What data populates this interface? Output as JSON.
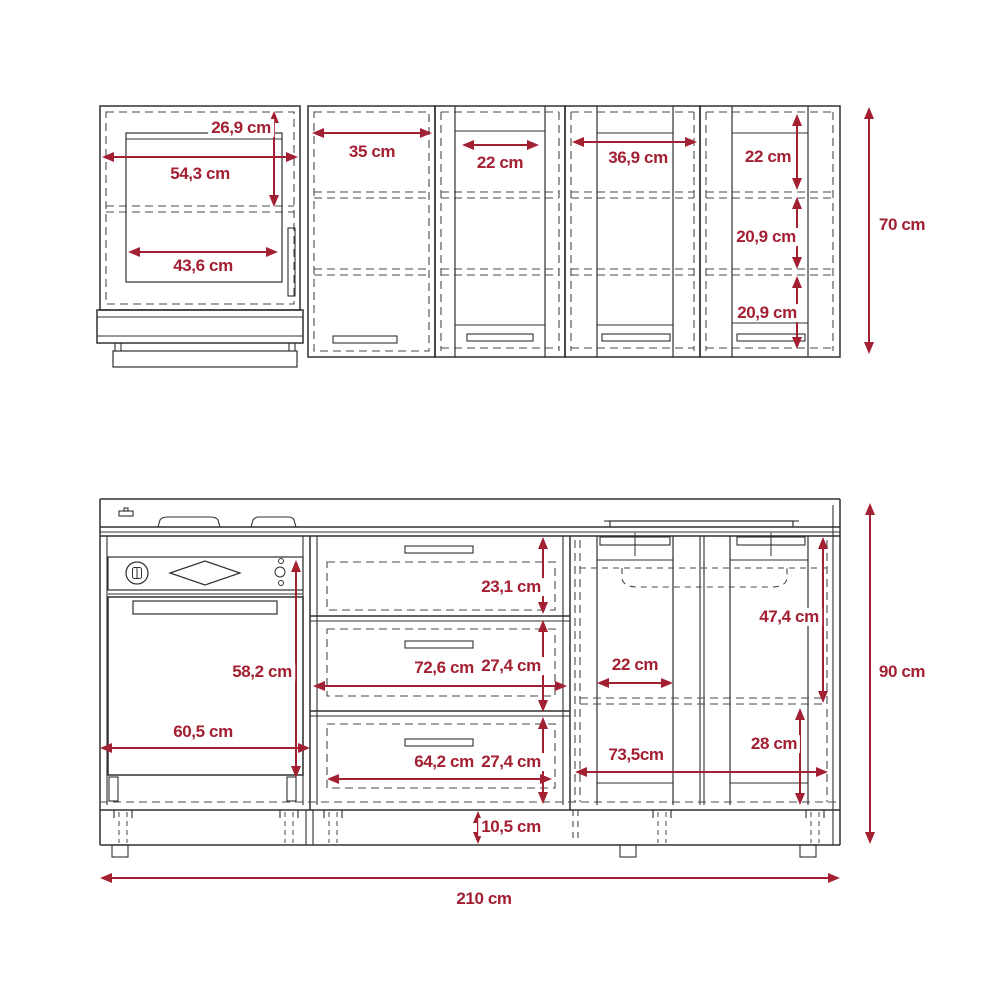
{
  "drawing": {
    "type": "technical-dimension-diagram",
    "subject": "Kitchen cabinet set - front elevation with dimensions",
    "unit": "cm",
    "accent_color": "#a32033",
    "line_color": "#303030",
    "overall_width_label": "210 cm",
    "upper_row_height_label": "70 cm",
    "lower_row_height_label": "90 cm",
    "components": [
      "wall-cabinet-hood",
      "wall-cabinet-2",
      "wall-cabinet-3",
      "wall-cabinet-4",
      "wall-cabinet-5",
      "range-hood",
      "cooktop-burners",
      "oven-unit",
      "drawer-unit",
      "sink-cabinet",
      "plinth"
    ]
  },
  "dimensions": [
    {
      "id": "upper-cab1-top-height",
      "label": "26,9 cm",
      "orient": "v",
      "x1": 274,
      "y1": 111,
      "x2": 274,
      "y2": 207,
      "lx": 241,
      "ly": 128
    },
    {
      "id": "upper-cab1-width",
      "label": "54,3 cm",
      "orient": "h",
      "x1": 102,
      "y1": 157,
      "x2": 298,
      "y2": 157,
      "lx": 200,
      "ly": 174
    },
    {
      "id": "upper-cab1-door-width",
      "label": "43,6 cm",
      "orient": "h",
      "x1": 128,
      "y1": 252,
      "x2": 278,
      "y2": 252,
      "lx": 203,
      "ly": 266
    },
    {
      "id": "upper-cab2-width",
      "label": "35 cm",
      "orient": "h",
      "x1": 312,
      "y1": 133,
      "x2": 432,
      "y2": 133,
      "lx": 372,
      "ly": 152
    },
    {
      "id": "upper-cab3-door-width",
      "label": "22 cm",
      "orient": "h",
      "x1": 462,
      "y1": 145,
      "x2": 539,
      "y2": 145,
      "lx": 500,
      "ly": 163
    },
    {
      "id": "upper-cab4-width",
      "label": "36,9 cm",
      "orient": "h",
      "x1": 572,
      "y1": 142,
      "x2": 697,
      "y2": 142,
      "lx": 638,
      "ly": 158
    },
    {
      "id": "upper-cab5-top-height",
      "label": "22 cm",
      "orient": "v",
      "x1": 797,
      "y1": 114,
      "x2": 797,
      "y2": 190,
      "lx": 768,
      "ly": 157
    },
    {
      "id": "upper-cab5-mid-height",
      "label": "20,9 cm",
      "orient": "v",
      "x1": 797,
      "y1": 197,
      "x2": 797,
      "y2": 269,
      "lx": 766,
      "ly": 237
    },
    {
      "id": "upper-cab5-bottom-height",
      "label": "20,9 cm",
      "orient": "v",
      "x1": 797,
      "y1": 276,
      "x2": 797,
      "y2": 349,
      "lx": 767,
      "ly": 313
    },
    {
      "id": "upper-overall-height",
      "label": "70 cm",
      "orient": "v",
      "x1": 869,
      "y1": 107,
      "x2": 869,
      "y2": 354,
      "lx": 902,
      "ly": 225
    },
    {
      "id": "lower-drawer1-height",
      "label": "23,1 cm",
      "orient": "v",
      "x1": 543,
      "y1": 537,
      "x2": 543,
      "y2": 614,
      "lx": 511,
      "ly": 587
    },
    {
      "id": "lower-drawer2-height",
      "label": "27,4 cm",
      "orient": "v",
      "x1": 543,
      "y1": 620,
      "x2": 543,
      "y2": 712,
      "lx": 511,
      "ly": 666
    },
    {
      "id": "lower-drawer-width",
      "label": "72,6 cm",
      "orient": "h",
      "x1": 313,
      "y1": 686,
      "x2": 567,
      "y2": 686,
      "lx": 444,
      "ly": 668
    },
    {
      "id": "lower-drawer3-height",
      "label": "27,4 cm",
      "orient": "v",
      "x1": 543,
      "y1": 717,
      "x2": 543,
      "y2": 804,
      "lx": 511,
      "ly": 762
    },
    {
      "id": "lower-drawer-inner-width",
      "label": "64,2 cm",
      "orient": "h",
      "x1": 327,
      "y1": 779,
      "x2": 552,
      "y2": 779,
      "lx": 444,
      "ly": 762
    },
    {
      "id": "lower-oven-height",
      "label": "58,2 cm",
      "orient": "v",
      "x1": 296,
      "y1": 560,
      "x2": 296,
      "y2": 778,
      "lx": 262,
      "ly": 672
    },
    {
      "id": "lower-oven-width",
      "label": "60,5 cm",
      "orient": "h",
      "x1": 100,
      "y1": 748,
      "x2": 310,
      "y2": 748,
      "lx": 203,
      "ly": 732
    },
    {
      "id": "lower-sink-door-width",
      "label": "22 cm",
      "orient": "h",
      "x1": 597,
      "y1": 683,
      "x2": 673,
      "y2": 683,
      "lx": 635,
      "ly": 665
    },
    {
      "id": "lower-sink-top-height",
      "label": "47,4 cm",
      "orient": "v",
      "x1": 823,
      "y1": 537,
      "x2": 823,
      "y2": 703,
      "lx": 789,
      "ly": 617
    },
    {
      "id": "lower-sink-width",
      "label": "73,5cm",
      "orient": "h",
      "x1": 575,
      "y1": 772,
      "x2": 828,
      "y2": 772,
      "lx": 636,
      "ly": 755
    },
    {
      "id": "lower-sink-bottom-height",
      "label": "28 cm",
      "orient": "v",
      "x1": 800,
      "y1": 708,
      "x2": 800,
      "y2": 805,
      "lx": 774,
      "ly": 744
    },
    {
      "id": "plinth-height",
      "label": "10,5 cm",
      "orient": "v",
      "x1": 478,
      "y1": 811,
      "x2": 478,
      "y2": 844,
      "lx": 511,
      "ly": 827
    },
    {
      "id": "lower-overall-height",
      "label": "90 cm",
      "orient": "v",
      "x1": 870,
      "y1": 503,
      "x2": 870,
      "y2": 844,
      "lx": 902,
      "ly": 672
    },
    {
      "id": "overall-width",
      "label": "210 cm",
      "orient": "h",
      "x1": 100,
      "y1": 878,
      "x2": 840,
      "y2": 878,
      "lx": 484,
      "ly": 899
    }
  ]
}
